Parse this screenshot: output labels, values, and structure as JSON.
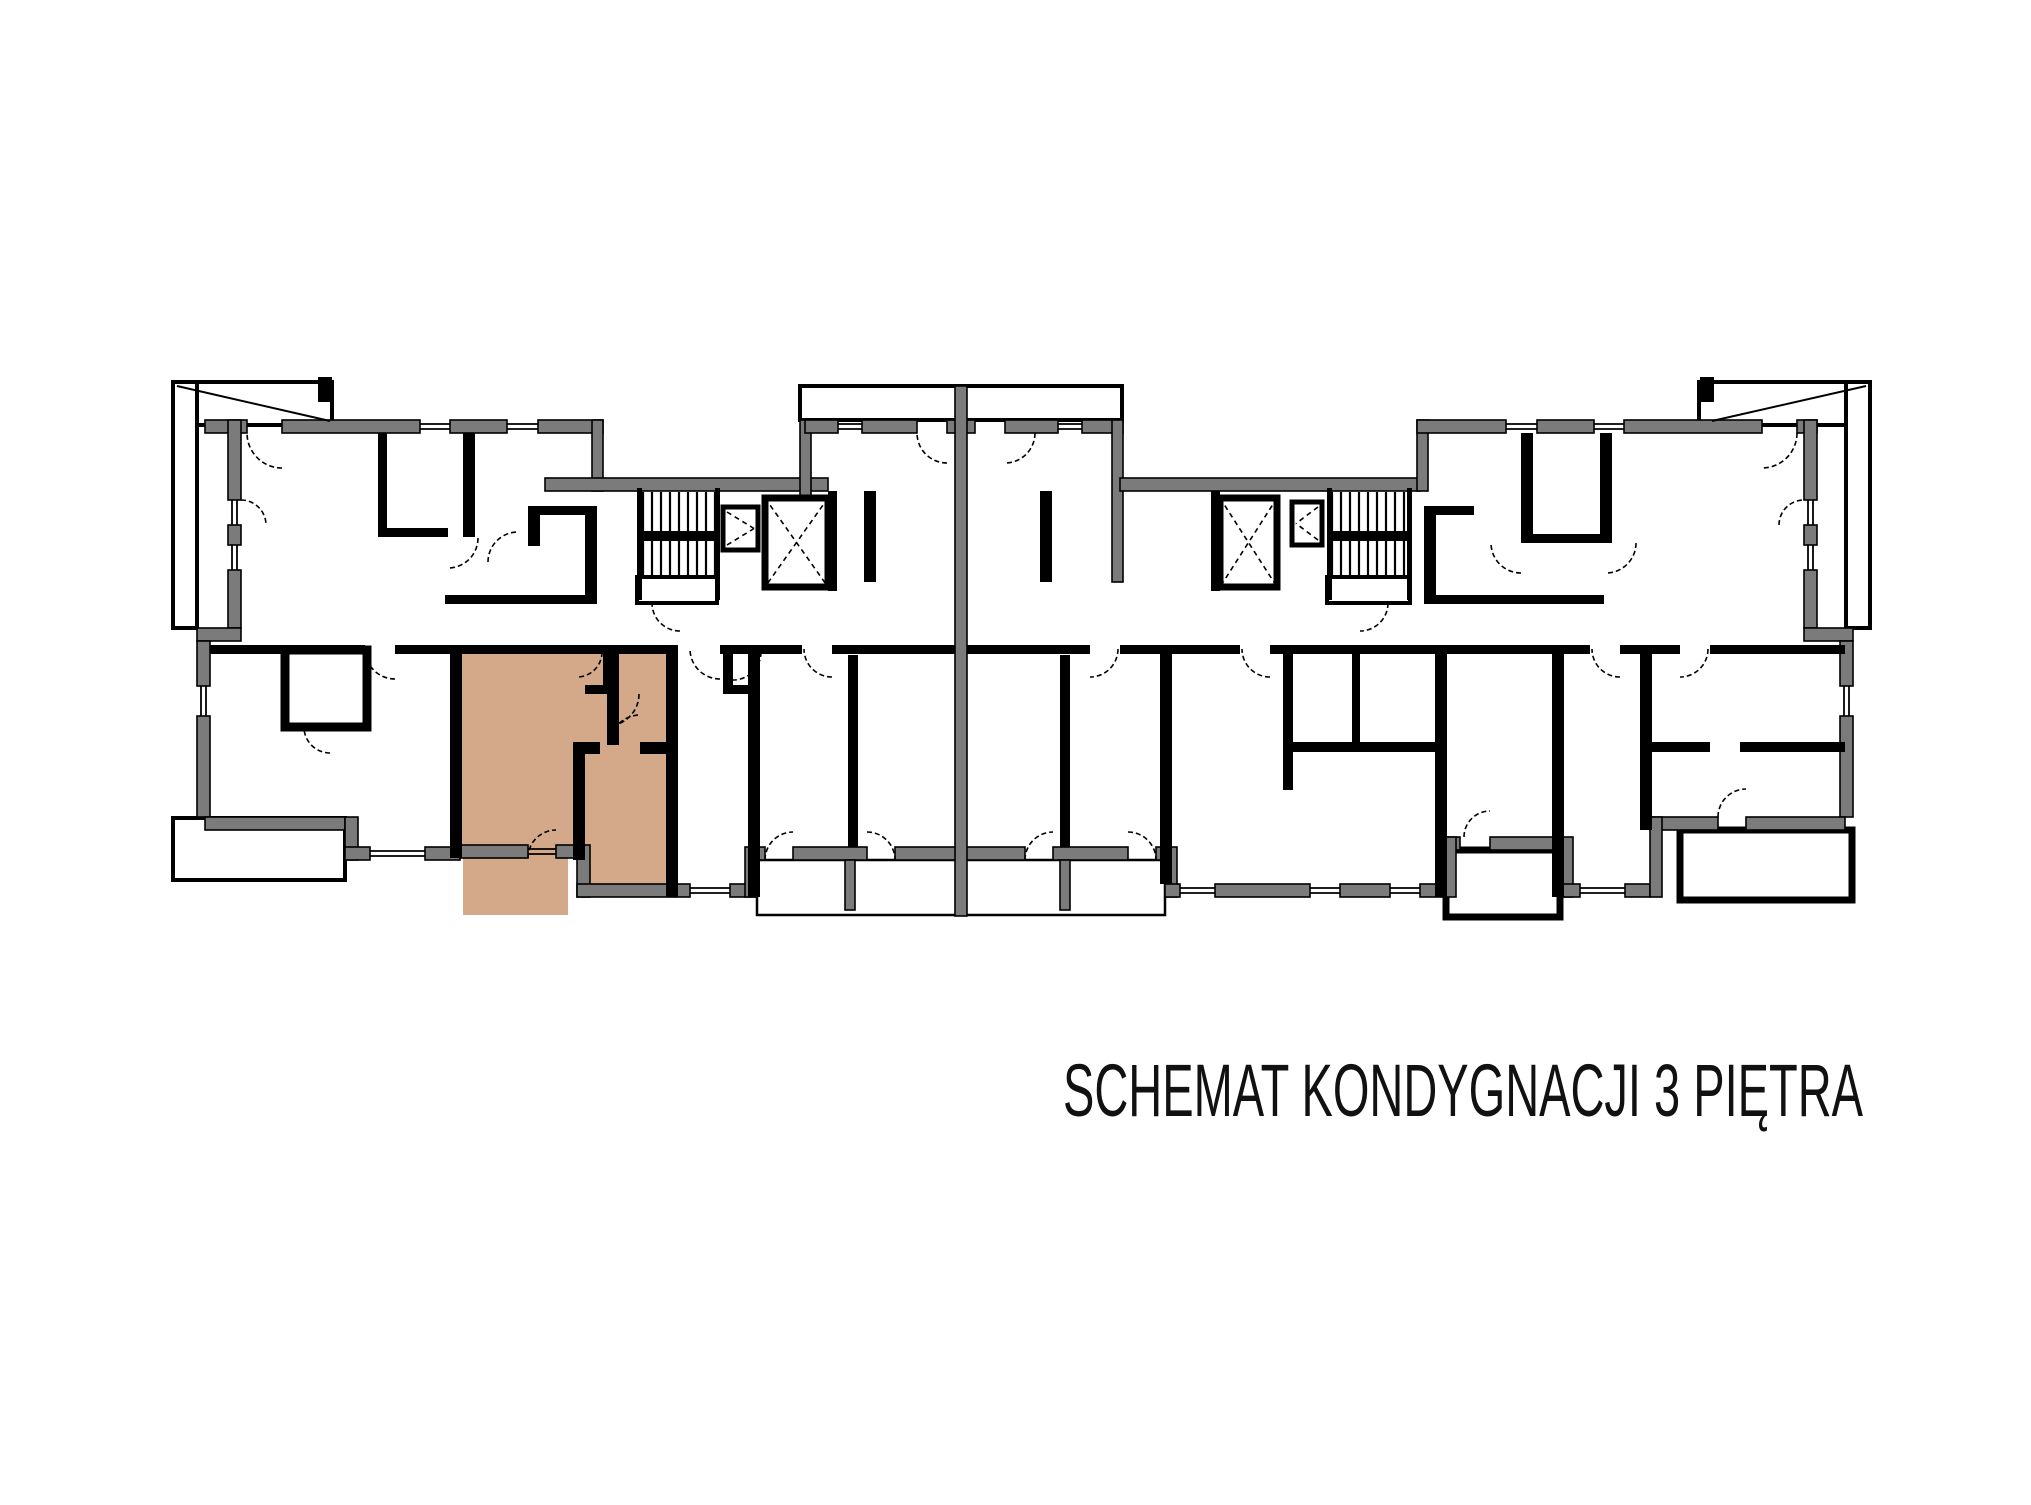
{
  "title": {
    "text": "SCHEMAT KONDYGNACJI 3 PIĘTRA"
  },
  "colors": {
    "background": "#ffffff",
    "wall_gray": "#7b7b7b",
    "wall_black": "#000000",
    "highlight_tan": "#d3a98a",
    "room_white": "#ffffff"
  },
  "canvas": {
    "width": 2031,
    "height": 1505
  },
  "title_layout": {
    "x": 1063,
    "y": 1116,
    "size": 74,
    "length": 800
  },
  "plan": {
    "highlight_rects": [
      [
        455,
        648,
        220,
        210
      ],
      [
        577,
        648,
        98,
        249
      ],
      [
        463,
        858,
        105,
        57
      ]
    ],
    "thin_white_rects": [
      [
        173,
        382,
        159,
        43
      ],
      [
        173,
        382,
        24,
        246
      ],
      [
        1699,
        382,
        171,
        43
      ],
      [
        1846,
        382,
        24,
        246
      ],
      [
        800,
        386,
        322,
        34
      ],
      [
        173,
        818,
        172,
        62
      ],
      [
        637,
        577,
        80,
        26
      ],
      [
        1327,
        577,
        83,
        26
      ]
    ],
    "thick_white_rects": [
      [
        1446,
        850,
        114,
        67
      ],
      [
        1680,
        830,
        172,
        70
      ]
    ],
    "box_white_rects": [
      [
        285,
        650,
        82,
        77
      ]
    ],
    "outline_rects": [
      [
        757,
        860,
        408,
        55
      ]
    ],
    "gray_rects": [
      [
        205,
        420,
        42,
        13
      ],
      [
        282,
        420,
        138,
        13
      ],
      [
        450,
        420,
        57,
        13
      ],
      [
        538,
        420,
        65,
        13
      ],
      [
        592,
        420,
        11,
        71
      ],
      [
        545,
        478,
        283,
        13
      ],
      [
        800,
        420,
        11,
        162
      ],
      [
        805,
        420,
        33,
        13
      ],
      [
        862,
        420,
        55,
        13
      ],
      [
        947,
        420,
        28,
        13
      ],
      [
        1005,
        420,
        53,
        13
      ],
      [
        1082,
        420,
        41,
        13
      ],
      [
        1112,
        420,
        11,
        162
      ],
      [
        1120,
        478,
        300,
        13
      ],
      [
        1417,
        420,
        11,
        71
      ],
      [
        1417,
        420,
        89,
        13
      ],
      [
        1537,
        420,
        57,
        13
      ],
      [
        1624,
        420,
        138,
        13
      ],
      [
        1797,
        420,
        20,
        13
      ],
      [
        228,
        420,
        13,
        80
      ],
      [
        228,
        525,
        13,
        20
      ],
      [
        228,
        570,
        13,
        58
      ],
      [
        197,
        628,
        44,
        13
      ],
      [
        197,
        641,
        13,
        45
      ],
      [
        197,
        716,
        13,
        101
      ],
      [
        1804,
        420,
        13,
        80
      ],
      [
        1804,
        525,
        13,
        20
      ],
      [
        1804,
        570,
        13,
        58
      ],
      [
        1804,
        628,
        49,
        13
      ],
      [
        1840,
        641,
        13,
        45
      ],
      [
        1840,
        716,
        13,
        101
      ],
      [
        205,
        817,
        140,
        13
      ],
      [
        345,
        817,
        13,
        43
      ],
      [
        345,
        847,
        25,
        13
      ],
      [
        425,
        847,
        35,
        13
      ],
      [
        460,
        845,
        68,
        13
      ],
      [
        556,
        845,
        21,
        13
      ],
      [
        577,
        845,
        13,
        52
      ],
      [
        577,
        884,
        98,
        13
      ],
      [
        675,
        884,
        15,
        13
      ],
      [
        730,
        884,
        27,
        13
      ],
      [
        745,
        847,
        12,
        50
      ],
      [
        757,
        847,
        8,
        13
      ],
      [
        793,
        847,
        74,
        13
      ],
      [
        895,
        847,
        130,
        13
      ],
      [
        1053,
        847,
        75,
        13
      ],
      [
        1156,
        847,
        9,
        13
      ],
      [
        1165,
        847,
        12,
        50
      ],
      [
        1165,
        884,
        15,
        13
      ],
      [
        1215,
        884,
        95,
        13
      ],
      [
        1340,
        884,
        50,
        13
      ],
      [
        1420,
        884,
        23,
        13
      ],
      [
        1443,
        837,
        17,
        13
      ],
      [
        1490,
        837,
        70,
        13
      ],
      [
        1443,
        837,
        13,
        60
      ],
      [
        1560,
        837,
        13,
        60
      ],
      [
        1560,
        884,
        20,
        13
      ],
      [
        1625,
        884,
        25,
        13
      ],
      [
        1650,
        817,
        68,
        13
      ],
      [
        1746,
        817,
        99,
        13
      ],
      [
        1650,
        817,
        12,
        80
      ],
      [
        955,
        386,
        12,
        530
      ],
      [
        845,
        860,
        10,
        50
      ],
      [
        1060,
        860,
        10,
        50
      ]
    ],
    "black_rects": [
      [
        378,
        433,
        9,
        100
      ],
      [
        378,
        528,
        70,
        9
      ],
      [
        463,
        433,
        12,
        104
      ],
      [
        528,
        506,
        12,
        40
      ],
      [
        528,
        506,
        62,
        9
      ],
      [
        585,
        506,
        12,
        98
      ],
      [
        445,
        595,
        152,
        9
      ],
      [
        828,
        491,
        9,
        100
      ],
      [
        1211,
        491,
        9,
        100
      ],
      [
        864,
        491,
        12,
        91
      ],
      [
        1040,
        491,
        12,
        91
      ],
      [
        1424,
        506,
        12,
        98
      ],
      [
        1424,
        506,
        50,
        9
      ],
      [
        1521,
        433,
        12,
        110
      ],
      [
        1521,
        534,
        85,
        9
      ],
      [
        1600,
        433,
        12,
        110
      ],
      [
        1424,
        595,
        180,
        9
      ],
      [
        210,
        645,
        155,
        9
      ],
      [
        395,
        645,
        280,
        9
      ],
      [
        720,
        645,
        37,
        9
      ],
      [
        757,
        645,
        45,
        9
      ],
      [
        832,
        645,
        123,
        9
      ],
      [
        967,
        645,
        123,
        9
      ],
      [
        1120,
        645,
        45,
        9
      ],
      [
        1165,
        645,
        75,
        9
      ],
      [
        1270,
        645,
        173,
        9
      ],
      [
        1443,
        645,
        117,
        9
      ],
      [
        1560,
        645,
        30,
        9
      ],
      [
        1620,
        645,
        30,
        9
      ],
      [
        1650,
        645,
        30,
        9
      ],
      [
        1710,
        645,
        135,
        9
      ],
      [
        450,
        645,
        12,
        213
      ],
      [
        603,
        652,
        12,
        42
      ],
      [
        585,
        685,
        30,
        9
      ],
      [
        607,
        652,
        12,
        93
      ],
      [
        573,
        742,
        27,
        12
      ],
      [
        640,
        742,
        35,
        12
      ],
      [
        573,
        742,
        12,
        118
      ],
      [
        666,
        645,
        12,
        252
      ],
      [
        748,
        652,
        12,
        245
      ],
      [
        723,
        652,
        10,
        40
      ],
      [
        723,
        685,
        32,
        9
      ],
      [
        848,
        655,
        10,
        192
      ],
      [
        1060,
        655,
        10,
        192
      ],
      [
        1160,
        652,
        12,
        232
      ],
      [
        1283,
        645,
        10,
        145
      ],
      [
        1288,
        742,
        155,
        10
      ],
      [
        1352,
        645,
        8,
        100
      ],
      [
        1435,
        645,
        12,
        252
      ],
      [
        1552,
        645,
        12,
        252
      ],
      [
        1640,
        645,
        12,
        185
      ],
      [
        1650,
        742,
        60,
        10
      ],
      [
        1740,
        742,
        105,
        10
      ],
      [
        637,
        488,
        5,
        112
      ],
      [
        715,
        488,
        5,
        112
      ],
      [
        1327,
        488,
        5,
        112
      ],
      [
        1407,
        488,
        5,
        112
      ],
      [
        318,
        377,
        14,
        25
      ],
      [
        1700,
        377,
        14,
        25
      ]
    ],
    "window_lines": [
      [
        420,
        424,
        450,
        424
      ],
      [
        420,
        429,
        450,
        429
      ],
      [
        507,
        424,
        538,
        424
      ],
      [
        507,
        429,
        538,
        429
      ],
      [
        838,
        424,
        862,
        424
      ],
      [
        838,
        429,
        862,
        429
      ],
      [
        1058,
        424,
        1082,
        424
      ],
      [
        1058,
        429,
        1082,
        429
      ],
      [
        1506,
        424,
        1537,
        424
      ],
      [
        1506,
        429,
        1537,
        429
      ],
      [
        1594,
        424,
        1624,
        424
      ],
      [
        1594,
        429,
        1624,
        429
      ],
      [
        232,
        500,
        232,
        525
      ],
      [
        237,
        500,
        237,
        525
      ],
      [
        232,
        545,
        232,
        570
      ],
      [
        237,
        545,
        237,
        570
      ],
      [
        201,
        686,
        201,
        716
      ],
      [
        206,
        686,
        206,
        716
      ],
      [
        1808,
        500,
        1808,
        525
      ],
      [
        1813,
        500,
        1813,
        525
      ],
      [
        1808,
        545,
        1808,
        570
      ],
      [
        1813,
        545,
        1813,
        570
      ],
      [
        1844,
        686,
        1844,
        716
      ],
      [
        1849,
        686,
        1849,
        716
      ],
      [
        370,
        851,
        425,
        851
      ],
      [
        370,
        856,
        425,
        856
      ],
      [
        528,
        849,
        556,
        849
      ],
      [
        528,
        854,
        556,
        854
      ],
      [
        690,
        888,
        730,
        888
      ],
      [
        690,
        893,
        730,
        893
      ],
      [
        1180,
        888,
        1215,
        888
      ],
      [
        1180,
        893,
        1215,
        893
      ],
      [
        1310,
        888,
        1340,
        888
      ],
      [
        1310,
        893,
        1340,
        893
      ],
      [
        1390,
        888,
        1420,
        888
      ],
      [
        1390,
        893,
        1420,
        893
      ],
      [
        1580,
        888,
        1625,
        888
      ],
      [
        1580,
        893,
        1625,
        893
      ]
    ],
    "diag_lines": [
      [
        177,
        386,
        330,
        421
      ],
      [
        1866,
        386,
        1712,
        421
      ]
    ],
    "stairs": [
      {
        "x": 643,
        "y": 492,
        "w": 72,
        "h": 85,
        "n": 8,
        "bar_y": 531
      },
      {
        "x": 1332,
        "y": 492,
        "w": 72,
        "h": 85,
        "n": 8,
        "bar_y": 531
      }
    ],
    "elevators": [
      {
        "x": 765,
        "y": 498,
        "w": 63,
        "h": 89,
        "kind": "x"
      },
      {
        "x": 1220,
        "y": 498,
        "w": 57,
        "h": 89,
        "kind": "x"
      },
      {
        "x": 723,
        "y": 507,
        "w": 35,
        "h": 43,
        "kind": "tri-r"
      },
      {
        "x": 1292,
        "y": 502,
        "w": 30,
        "h": 43,
        "kind": "tri-l"
      }
    ],
    "door_arcs": [
      [
        282,
        433,
        35,
        90,
        180
      ],
      [
        947,
        433,
        30,
        90,
        180
      ],
      [
        1005,
        433,
        30,
        0,
        90
      ],
      [
        1762,
        433,
        35,
        0,
        90
      ],
      [
        241,
        525,
        25,
        270,
        360
      ],
      [
        448,
        538,
        30,
        0,
        90
      ],
      [
        518,
        562,
        30,
        180,
        270
      ],
      [
        680,
        603,
        28,
        90,
        180
      ],
      [
        1360,
        603,
        28,
        0,
        90
      ],
      [
        395,
        649,
        30,
        90,
        180
      ],
      [
        577,
        652,
        25,
        0,
        90
      ],
      [
        607,
        694,
        32,
        0,
        90
      ],
      [
        640,
        745,
        30,
        180,
        270
      ],
      [
        556,
        858,
        28,
        180,
        270
      ],
      [
        720,
        649,
        30,
        90,
        180
      ],
      [
        330,
        727,
        26,
        90,
        180
      ],
      [
        733,
        652,
        28,
        0,
        90
      ],
      [
        793,
        860,
        28,
        180,
        270
      ],
      [
        867,
        860,
        28,
        270,
        360
      ],
      [
        1053,
        860,
        28,
        180,
        270
      ],
      [
        1128,
        860,
        28,
        270,
        360
      ],
      [
        832,
        649,
        28,
        90,
        180
      ],
      [
        1090,
        649,
        28,
        0,
        90
      ],
      [
        1270,
        649,
        28,
        90,
        180
      ],
      [
        1490,
        837,
        26,
        180,
        270
      ],
      [
        1620,
        649,
        28,
        90,
        180
      ],
      [
        1680,
        649,
        28,
        0,
        90
      ],
      [
        1746,
        817,
        28,
        180,
        270
      ],
      [
        1804,
        525,
        25,
        180,
        270
      ],
      [
        1521,
        543,
        30,
        90,
        180
      ],
      [
        1606,
        543,
        30,
        0,
        90
      ]
    ]
  }
}
